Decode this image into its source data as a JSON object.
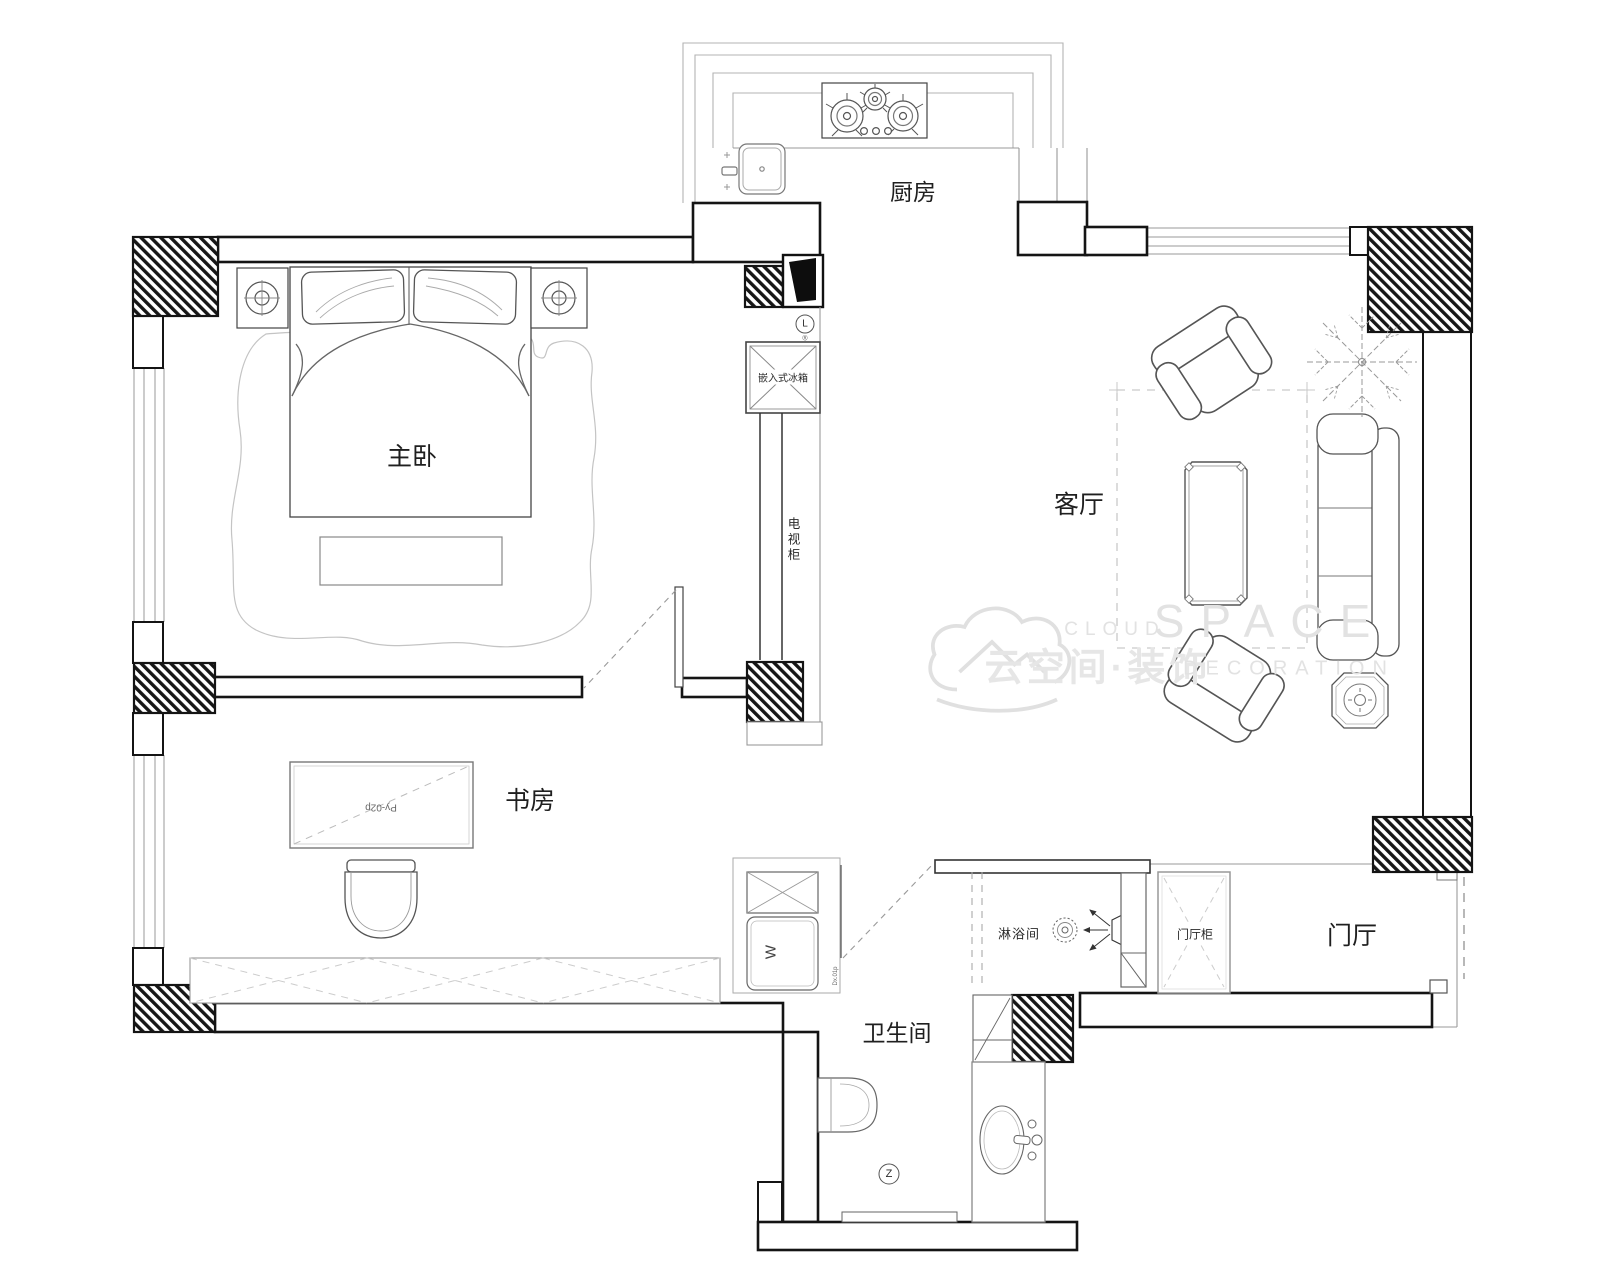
{
  "title": "户型平面布置图",
  "rooms": {
    "kitchen": "厨房",
    "master_bedroom": "主卧",
    "living_room": "客厅",
    "study": "书房",
    "bathroom": "卫生间",
    "shower_room": "淋浴间",
    "entry_hall": "门厅"
  },
  "fixtures": {
    "fridge": "嵌入式冰箱",
    "tv_cabinet": "电视柜",
    "entry_cabinet": "门厅柜",
    "desk_code": "Py-02p",
    "door_code": "Dx.01p",
    "washer_symbol": "W",
    "light_symbol": "L",
    "reg_symbol": "®",
    "drain_symbol": "Z"
  },
  "watermark": {
    "brand_en_small": "CLOUD",
    "brand_en_large": "SPACE",
    "brand_cn": "云空间·装饰",
    "brand_en_sub": "DECORATION"
  },
  "colors": {
    "wall_line": "#141414",
    "furniture_line": "#555555",
    "light_line": "#9a9a9a",
    "dashed_line": "#bbbbbb",
    "watermark": "#e2e2e2",
    "background": "#ffffff"
  }
}
